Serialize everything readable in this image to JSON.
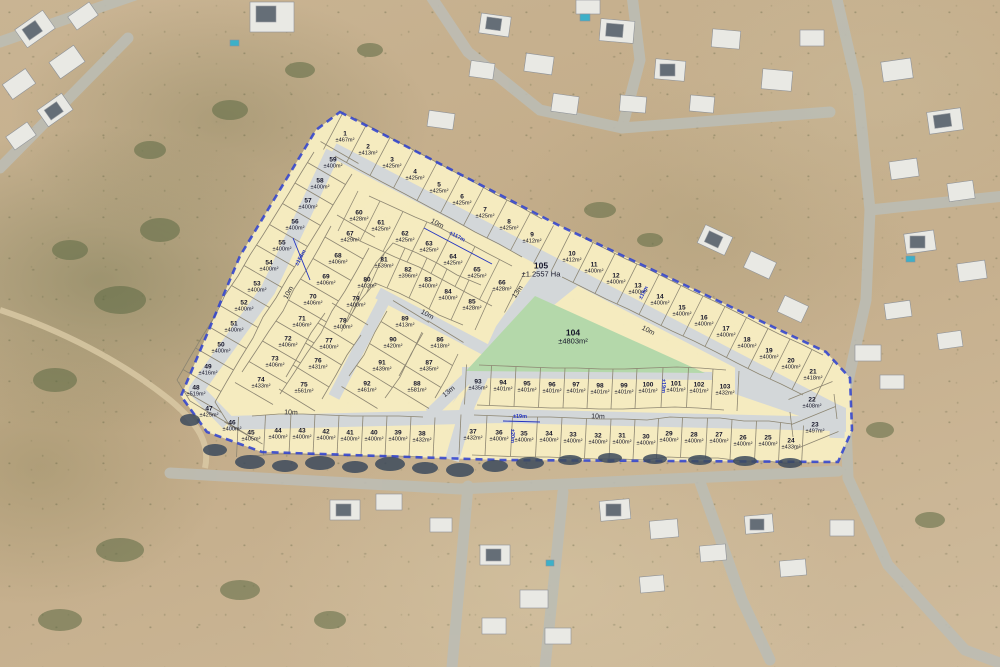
{
  "scene_title": "Aerial erf layout plan overlay",
  "colors": {
    "lot_fill": "#f7edc2",
    "road_fill": "#d3d7d9",
    "open_space_green": "#b4d8aa",
    "boundary_dash_blue": "#2b3fd0",
    "parcel_line": "#8d8672",
    "dimension_blue": "#2334c0"
  },
  "lots": [
    {
      "n": "1",
      "area": "±467m²",
      "x": 345,
      "y": 137
    },
    {
      "n": "2",
      "area": "±413m²",
      "x": 368,
      "y": 150
    },
    {
      "n": "3",
      "area": "±425m²",
      "x": 392,
      "y": 163
    },
    {
      "n": "4",
      "area": "±425m²",
      "x": 415,
      "y": 175
    },
    {
      "n": "5",
      "area": "±425m²",
      "x": 439,
      "y": 188
    },
    {
      "n": "6",
      "area": "±425m²",
      "x": 462,
      "y": 200
    },
    {
      "n": "7",
      "area": "±425m²",
      "x": 485,
      "y": 213
    },
    {
      "n": "8",
      "area": "±425m²",
      "x": 509,
      "y": 225
    },
    {
      "n": "9",
      "area": "±412m²",
      "x": 532,
      "y": 238
    },
    {
      "n": "10",
      "area": "±412m²",
      "x": 572,
      "y": 257
    },
    {
      "n": "11",
      "area": "±400m²",
      "x": 594,
      "y": 268
    },
    {
      "n": "12",
      "area": "±400m²",
      "x": 616,
      "y": 279
    },
    {
      "n": "13",
      "area": "±400m²",
      "x": 638,
      "y": 289
    },
    {
      "n": "14",
      "area": "±400m²",
      "x": 660,
      "y": 300
    },
    {
      "n": "15",
      "area": "±400m²",
      "x": 682,
      "y": 311
    },
    {
      "n": "16",
      "area": "±400m²",
      "x": 704,
      "y": 321
    },
    {
      "n": "17",
      "area": "±400m²",
      "x": 726,
      "y": 332
    },
    {
      "n": "18",
      "area": "±400m²",
      "x": 747,
      "y": 343
    },
    {
      "n": "19",
      "area": "±400m²",
      "x": 769,
      "y": 354
    },
    {
      "n": "20",
      "area": "±400m²",
      "x": 791,
      "y": 364
    },
    {
      "n": "21",
      "area": "±418m²",
      "x": 813,
      "y": 375
    },
    {
      "n": "22",
      "area": "±408m²",
      "x": 812,
      "y": 403
    },
    {
      "n": "23",
      "area": "±497m²",
      "x": 815,
      "y": 428
    },
    {
      "n": "24",
      "area": "±433m²",
      "x": 791,
      "y": 444
    },
    {
      "n": "25",
      "area": "±400m²",
      "x": 768,
      "y": 441
    },
    {
      "n": "26",
      "area": "±400m²",
      "x": 743,
      "y": 441
    },
    {
      "n": "27",
      "area": "±400m²",
      "x": 719,
      "y": 438
    },
    {
      "n": "28",
      "area": "±400m²",
      "x": 694,
      "y": 438
    },
    {
      "n": "29",
      "area": "±400m²",
      "x": 669,
      "y": 437
    },
    {
      "n": "30",
      "area": "±400m²",
      "x": 646,
      "y": 440
    },
    {
      "n": "31",
      "area": "±400m²",
      "x": 622,
      "y": 439
    },
    {
      "n": "32",
      "area": "±400m²",
      "x": 598,
      "y": 439
    },
    {
      "n": "33",
      "area": "±400m²",
      "x": 573,
      "y": 438
    },
    {
      "n": "34",
      "area": "±400m²",
      "x": 549,
      "y": 437
    },
    {
      "n": "35",
      "area": "±400m²",
      "x": 524,
      "y": 437
    },
    {
      "n": "36",
      "area": "±400m²",
      "x": 499,
      "y": 436
    },
    {
      "n": "37",
      "area": "±432m²",
      "x": 473,
      "y": 435
    },
    {
      "n": "38",
      "area": "±432m²",
      "x": 422,
      "y": 437
    },
    {
      "n": "39",
      "area": "±400m²",
      "x": 398,
      "y": 436
    },
    {
      "n": "40",
      "area": "±400m²",
      "x": 374,
      "y": 436
    },
    {
      "n": "41",
      "area": "±400m²",
      "x": 350,
      "y": 436
    },
    {
      "n": "42",
      "area": "±400m²",
      "x": 326,
      "y": 435
    },
    {
      "n": "43",
      "area": "±400m²",
      "x": 302,
      "y": 434
    },
    {
      "n": "44",
      "area": "±400m²",
      "x": 278,
      "y": 434
    },
    {
      "n": "45",
      "area": "±405m²",
      "x": 251,
      "y": 436
    },
    {
      "n": "46",
      "area": "±400m²",
      "x": 232,
      "y": 426
    },
    {
      "n": "47",
      "area": "±425m²",
      "x": 209,
      "y": 412
    },
    {
      "n": "48",
      "area": "±519m²",
      "x": 196,
      "y": 391
    },
    {
      "n": "49",
      "area": "±416m²",
      "x": 208,
      "y": 370
    },
    {
      "n": "50",
      "area": "±400m²",
      "x": 221,
      "y": 348
    },
    {
      "n": "51",
      "area": "±400m²",
      "x": 234,
      "y": 327
    },
    {
      "n": "52",
      "area": "±400m²",
      "x": 244,
      "y": 306
    },
    {
      "n": "53",
      "area": "±400m²",
      "x": 257,
      "y": 287
    },
    {
      "n": "54",
      "area": "±400m²",
      "x": 269,
      "y": 266
    },
    {
      "n": "55",
      "area": "±400m²",
      "x": 282,
      "y": 246
    },
    {
      "n": "56",
      "area": "±400m²",
      "x": 295,
      "y": 225
    },
    {
      "n": "57",
      "area": "±400m²",
      "x": 308,
      "y": 204
    },
    {
      "n": "58",
      "area": "±400m²",
      "x": 320,
      "y": 184
    },
    {
      "n": "59",
      "area": "±400m²",
      "x": 333,
      "y": 163
    },
    {
      "n": "60",
      "area": "±428m²",
      "x": 359,
      "y": 216
    },
    {
      "n": "61",
      "area": "±425m²",
      "x": 381,
      "y": 226
    },
    {
      "n": "62",
      "area": "±425m²",
      "x": 405,
      "y": 237
    },
    {
      "n": "63",
      "area": "±425m²",
      "x": 429,
      "y": 247
    },
    {
      "n": "64",
      "area": "±425m²",
      "x": 453,
      "y": 260
    },
    {
      "n": "65",
      "area": "±425m²",
      "x": 477,
      "y": 273
    },
    {
      "n": "66",
      "area": "±428m²",
      "x": 502,
      "y": 286
    },
    {
      "n": "67",
      "area": "±429m²",
      "x": 350,
      "y": 237
    },
    {
      "n": "68",
      "area": "±406m²",
      "x": 338,
      "y": 259
    },
    {
      "n": "69",
      "area": "±406m²",
      "x": 326,
      "y": 280
    },
    {
      "n": "70",
      "area": "±406m²",
      "x": 313,
      "y": 300
    },
    {
      "n": "71",
      "area": "±406m²",
      "x": 302,
      "y": 322
    },
    {
      "n": "72",
      "area": "±406m²",
      "x": 288,
      "y": 342
    },
    {
      "n": "73",
      "area": "±406m²",
      "x": 275,
      "y": 362
    },
    {
      "n": "74",
      "area": "±433m²",
      "x": 261,
      "y": 383
    },
    {
      "n": "75",
      "area": "±561m²",
      "x": 304,
      "y": 388
    },
    {
      "n": "76",
      "area": "±431m²",
      "x": 318,
      "y": 364
    },
    {
      "n": "77",
      "area": "±400m²",
      "x": 329,
      "y": 344
    },
    {
      "n": "78",
      "area": "±400m²",
      "x": 343,
      "y": 324
    },
    {
      "n": "79",
      "area": "±400m²",
      "x": 356,
      "y": 302
    },
    {
      "n": "80",
      "area": "±402m²",
      "x": 367,
      "y": 283
    },
    {
      "n": "81",
      "area": "±539m²",
      "x": 384,
      "y": 263
    },
    {
      "n": "82",
      "area": "±396m²",
      "x": 408,
      "y": 273
    },
    {
      "n": "83",
      "area": "±400m²",
      "x": 428,
      "y": 283
    },
    {
      "n": "84",
      "area": "±400m²",
      "x": 448,
      "y": 295
    },
    {
      "n": "85",
      "area": "±428m²",
      "x": 472,
      "y": 305
    },
    {
      "n": "86",
      "area": "±418m²",
      "x": 440,
      "y": 343
    },
    {
      "n": "87",
      "area": "±435m²",
      "x": 429,
      "y": 366
    },
    {
      "n": "88",
      "area": "±581m²",
      "x": 417,
      "y": 387
    },
    {
      "n": "89",
      "area": "±413m²",
      "x": 405,
      "y": 322
    },
    {
      "n": "90",
      "area": "±420m²",
      "x": 393,
      "y": 343
    },
    {
      "n": "91",
      "area": "±439m²",
      "x": 382,
      "y": 366
    },
    {
      "n": "92",
      "area": "±461m²",
      "x": 367,
      "y": 387
    },
    {
      "n": "93",
      "area": "±435m²",
      "x": 478,
      "y": 385
    },
    {
      "n": "94",
      "area": "±401m²",
      "x": 503,
      "y": 386
    },
    {
      "n": "95",
      "area": "±401m²",
      "x": 527,
      "y": 387
    },
    {
      "n": "96",
      "area": "±401m²",
      "x": 552,
      "y": 388
    },
    {
      "n": "97",
      "area": "±401m²",
      "x": 576,
      "y": 388
    },
    {
      "n": "98",
      "area": "±401m²",
      "x": 600,
      "y": 389
    },
    {
      "n": "99",
      "area": "±401m²",
      "x": 624,
      "y": 389
    },
    {
      "n": "100",
      "area": "±401m²",
      "x": 648,
      "y": 388
    },
    {
      "n": "101",
      "area": "±401m²",
      "x": 676,
      "y": 387
    },
    {
      "n": "102",
      "area": "±401m²",
      "x": 699,
      "y": 388
    },
    {
      "n": "103",
      "area": "±432m²",
      "x": 725,
      "y": 390
    }
  ],
  "open_spaces": [
    {
      "n": "104",
      "area": "±4803m²",
      "x": 573,
      "y": 337
    },
    {
      "n": "105",
      "area": "±1.2557 Ha",
      "x": 541,
      "y": 270
    }
  ],
  "road_labels": [
    {
      "text": "10m",
      "x": 437,
      "y": 224,
      "rot": 28
    },
    {
      "text": "10m",
      "x": 648,
      "y": 331,
      "rot": 27
    },
    {
      "text": "10m",
      "x": 289,
      "y": 293,
      "rot": -61
    },
    {
      "text": "10m",
      "x": 291,
      "y": 413,
      "rot": 2
    },
    {
      "text": "10m",
      "x": 598,
      "y": 417,
      "rot": 2
    },
    {
      "text": "10m",
      "x": 427,
      "y": 315,
      "rot": 29
    },
    {
      "text": "13m",
      "x": 518,
      "y": 292,
      "rot": -55
    },
    {
      "text": "13m",
      "x": 449,
      "y": 392,
      "rot": -40
    }
  ],
  "dimension_labels": [
    {
      "text": "±117m",
      "x": 457,
      "y": 237,
      "rot": 28
    },
    {
      "text": "±158m",
      "x": 301,
      "y": 258,
      "rot": -61
    },
    {
      "text": "±19m",
      "x": 520,
      "y": 417,
      "rot": 0
    },
    {
      "text": "±20m",
      "x": 512,
      "y": 436,
      "rot": 90
    },
    {
      "text": "±19m",
      "x": 663,
      "y": 386,
      "rot": 90
    },
    {
      "text": "±19m",
      "x": 644,
      "y": 293,
      "rot": -62
    }
  ],
  "geometry": {
    "strips": [
      {
        "ids": [
          "1",
          "2",
          "3",
          "4",
          "5",
          "6",
          "7",
          "8",
          "9"
        ],
        "v": [
          -10,
          19
        ]
      },
      {
        "ids": [
          "10",
          "11",
          "12",
          "13",
          "14",
          "15",
          "16",
          "17",
          "18",
          "19",
          "20",
          "21"
        ],
        "v": [
          -10,
          20
        ]
      },
      {
        "ids": [
          "22",
          "23"
        ],
        "v": [
          22,
          -9
        ]
      },
      {
        "ids": [
          "24",
          "25",
          "26",
          "27",
          "28",
          "29",
          "30",
          "31",
          "32",
          "33",
          "34",
          "35",
          "36",
          "37"
        ],
        "v": [
          -1,
          20
        ]
      },
      {
        "ids": [
          "38",
          "39",
          "40",
          "41",
          "42",
          "43",
          "44",
          "45"
        ],
        "v": [
          -1,
          20
        ]
      },
      {
        "ids": [
          "46",
          "47",
          "48",
          "49",
          "50",
          "51",
          "52",
          "53",
          "54",
          "55",
          "56",
          "57",
          "58",
          "59"
        ],
        "v": [
          19,
          11
        ]
      },
      {
        "ids": [
          "60",
          "61",
          "62",
          "63",
          "64",
          "65",
          "66"
        ],
        "v": [
          -10,
          20
        ]
      },
      {
        "ids": [
          "67",
          "68",
          "69",
          "70",
          "71",
          "72",
          "73",
          "74"
        ],
        "v": [
          19,
          11
        ]
      },
      {
        "ids": [
          "75",
          "76",
          "77",
          "78"
        ],
        "v": [
          18,
          11
        ]
      },
      {
        "ids": [
          "79",
          "80",
          "81",
          "82",
          "83",
          "84",
          "85"
        ],
        "v": [
          -9,
          20
        ]
      },
      {
        "ids": [
          "86",
          "87",
          "88"
        ],
        "v": [
          18,
          11
        ]
      },
      {
        "ids": [
          "89",
          "90",
          "91",
          "92"
        ],
        "v": [
          18,
          11
        ]
      },
      {
        "ids": [
          "93",
          "94",
          "95",
          "96",
          "97",
          "98",
          "99",
          "100",
          "101",
          "102",
          "103"
        ],
        "v": [
          -1,
          20
        ]
      }
    ]
  }
}
